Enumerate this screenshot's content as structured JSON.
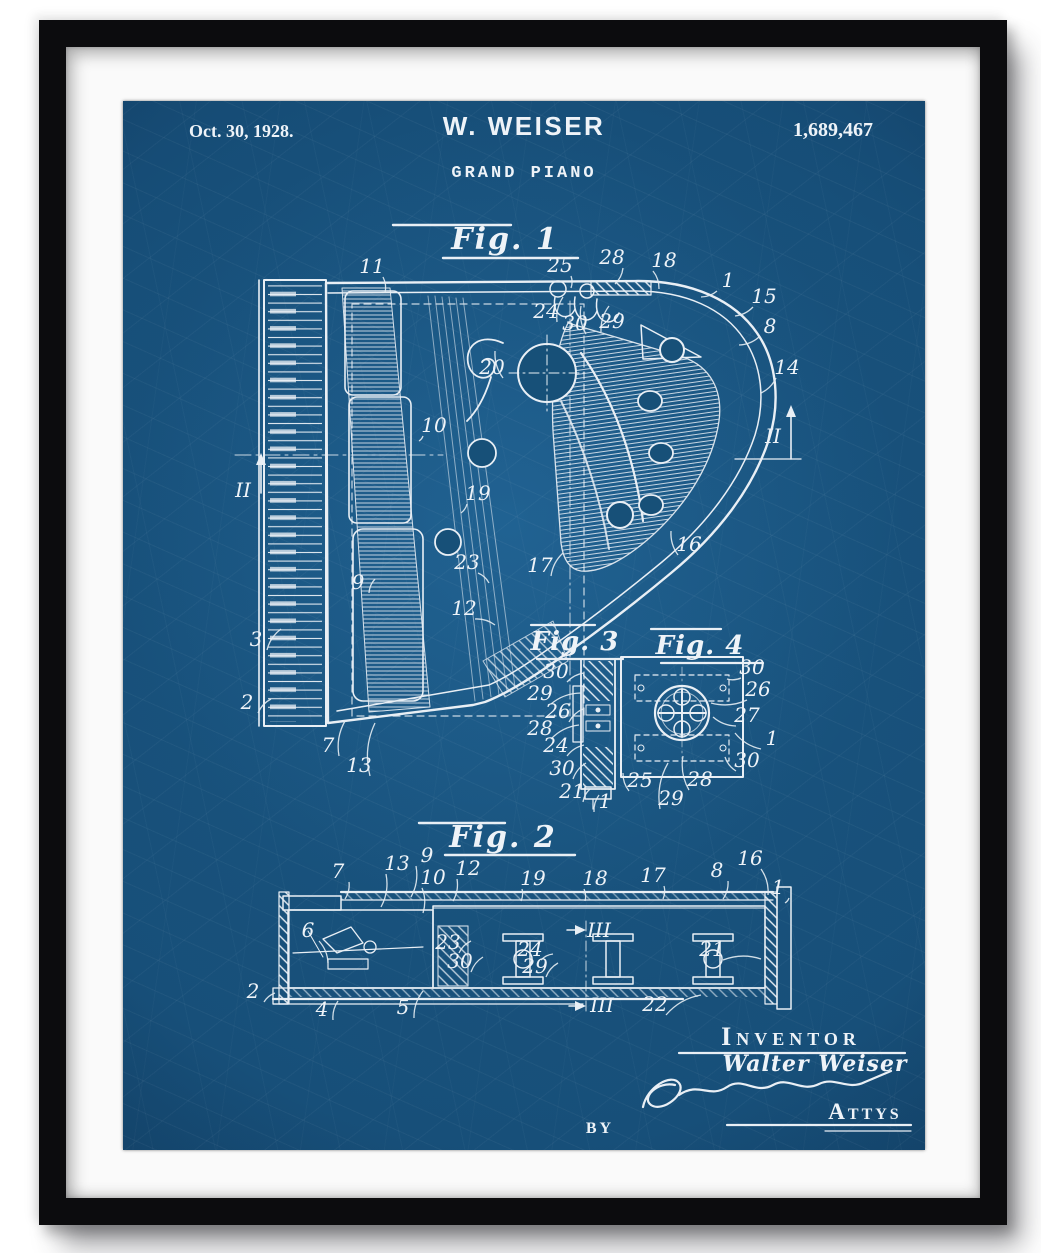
{
  "artwork": {
    "header": {
      "date": "Oct. 30, 1928.",
      "inventor_name": "W. WEISER",
      "patent_number": "1,689,467",
      "patent_title": "GRAND PIANO"
    },
    "figures": {
      "fig1": {
        "label": "Fig. 1",
        "ref_labels": [
          {
            "t": "11",
            "x": 249,
            "y": 172,
            "lx": 262,
            "ly": 192
          },
          {
            "t": "25",
            "x": 437,
            "y": 171,
            "lx": 448,
            "ly": 187
          },
          {
            "t": "28",
            "x": 489,
            "y": 163,
            "lx": 492,
            "ly": 183
          },
          {
            "t": "18",
            "x": 541,
            "y": 166,
            "lx": 536,
            "ly": 188
          },
          {
            "t": "24",
            "x": 423,
            "y": 217,
            "lx": 440,
            "ly": 196
          },
          {
            "t": "30",
            "x": 452,
            "y": 229,
            "lx": 458,
            "ly": 205
          },
          {
            "t": "29",
            "x": 489,
            "y": 227,
            "lx": 486,
            "ly": 205
          },
          {
            "t": "1",
            "x": 605,
            "y": 186,
            "lx": 578,
            "ly": 196
          },
          {
            "t": "15",
            "x": 641,
            "y": 202,
            "lx": 612,
            "ly": 215
          },
          {
            "t": "8",
            "x": 647,
            "y": 232,
            "lx": 616,
            "ly": 244
          },
          {
            "t": "14",
            "x": 664,
            "y": 273,
            "lx": 638,
            "ly": 292
          },
          {
            "t": "II",
            "x": 650,
            "y": 342
          },
          {
            "t": "20",
            "x": 369,
            "y": 273,
            "lx": 372,
            "ly": 250
          },
          {
            "t": "10",
            "x": 311,
            "y": 331,
            "lx": 296,
            "ly": 340
          },
          {
            "t": "II",
            "x": 120,
            "y": 396
          },
          {
            "t": "19",
            "x": 355,
            "y": 399,
            "lx": 338,
            "ly": 412
          },
          {
            "t": "9",
            "x": 235,
            "y": 488,
            "lx": 252,
            "ly": 478
          },
          {
            "t": "23",
            "x": 344,
            "y": 468,
            "lx": 366,
            "ly": 482
          },
          {
            "t": "12",
            "x": 341,
            "y": 514,
            "lx": 372,
            "ly": 524
          },
          {
            "t": "3",
            "x": 133,
            "y": 545,
            "lx": 158,
            "ly": 528
          },
          {
            "t": "2",
            "x": 124,
            "y": 608,
            "lx": 148,
            "ly": 598
          },
          {
            "t": "7",
            "x": 205,
            "y": 651,
            "lx": 222,
            "ly": 620
          },
          {
            "t": "13",
            "x": 236,
            "y": 671,
            "lx": 252,
            "ly": 622
          },
          {
            "t": "17",
            "x": 417,
            "y": 471,
            "lx": 440,
            "ly": 452
          },
          {
            "t": "16",
            "x": 566,
            "y": 450,
            "lx": 548,
            "ly": 430
          }
        ]
      },
      "fig2": {
        "label": "Fig. 2",
        "ref_labels": [
          {
            "t": "7",
            "x": 215,
            "y": 777,
            "lx": 222,
            "ly": 798
          },
          {
            "t": "13",
            "x": 274,
            "y": 769,
            "lx": 258,
            "ly": 806
          },
          {
            "t": "9",
            "x": 304,
            "y": 761,
            "lx": 288,
            "ly": 796
          },
          {
            "t": "10",
            "x": 310,
            "y": 783,
            "lx": 300,
            "ly": 812
          },
          {
            "t": "12",
            "x": 345,
            "y": 774,
            "lx": 330,
            "ly": 800
          },
          {
            "t": "19",
            "x": 410,
            "y": 784,
            "lx": 398,
            "ly": 800
          },
          {
            "t": "18",
            "x": 472,
            "y": 784,
            "lx": 462,
            "ly": 800
          },
          {
            "t": "17",
            "x": 530,
            "y": 781,
            "lx": 540,
            "ly": 798
          },
          {
            "t": "8",
            "x": 594,
            "y": 776,
            "lx": 600,
            "ly": 798
          },
          {
            "t": "16",
            "x": 627,
            "y": 764,
            "lx": 645,
            "ly": 794
          },
          {
            "t": "1",
            "x": 655,
            "y": 793,
            "lx": 662,
            "ly": 802
          },
          {
            "t": "6",
            "x": 185,
            "y": 836,
            "lx": 205,
            "ly": 862
          },
          {
            "t": "23",
            "x": 325,
            "y": 848,
            "lx": 348,
            "ly": 840
          },
          {
            "t": "30",
            "x": 337,
            "y": 867,
            "lx": 360,
            "ly": 856
          },
          {
            "t": "24",
            "x": 407,
            "y": 855,
            "lx": 430,
            "ly": 853
          },
          {
            "t": "29",
            "x": 412,
            "y": 872,
            "lx": 435,
            "ly": 862
          },
          {
            "t": "III",
            "x": 476,
            "y": 836
          },
          {
            "t": "III",
            "x": 479,
            "y": 911
          },
          {
            "t": "21",
            "x": 589,
            "y": 855,
            "lx": 638,
            "ly": 858
          },
          {
            "t": "22",
            "x": 532,
            "y": 910,
            "lx": 578,
            "ly": 894
          },
          {
            "t": "2",
            "x": 130,
            "y": 897,
            "lx": 152,
            "ly": 892
          },
          {
            "t": "4",
            "x": 199,
            "y": 915,
            "lx": 215,
            "ly": 900
          },
          {
            "t": "5",
            "x": 280,
            "y": 913,
            "lx": 300,
            "ly": 890
          }
        ]
      },
      "fig3": {
        "label": "Fig. 3",
        "ref_labels": [
          {
            "t": "30",
            "x": 433,
            "y": 577,
            "lx": 461,
            "ly": 572
          },
          {
            "t": "29",
            "x": 417,
            "y": 599,
            "lx": 458,
            "ly": 592
          },
          {
            "t": "26",
            "x": 435,
            "y": 617,
            "lx": 460,
            "ly": 608
          },
          {
            "t": "28",
            "x": 417,
            "y": 634,
            "lx": 456,
            "ly": 624
          },
          {
            "t": "24",
            "x": 433,
            "y": 651,
            "lx": 461,
            "ly": 644
          },
          {
            "t": "30",
            "x": 439,
            "y": 674,
            "lx": 463,
            "ly": 662
          },
          {
            "t": "21",
            "x": 449,
            "y": 697,
            "lx": 467,
            "ly": 688
          },
          {
            "t": "25",
            "x": 517,
            "y": 686,
            "lx": 500,
            "ly": 672
          },
          {
            "t": "1",
            "x": 482,
            "y": 707,
            "lx": 476,
            "ly": 694
          },
          {
            "t": "29",
            "x": 548,
            "y": 704,
            "lx": 545,
            "ly": 662
          },
          {
            "t": "28",
            "x": 577,
            "y": 685,
            "lx": 560,
            "ly": 655
          }
        ]
      },
      "fig4": {
        "label": "Fig. 4",
        "ref_labels": [
          {
            "t": "30",
            "x": 629,
            "y": 573,
            "lx": 604,
            "ly": 578
          },
          {
            "t": "26",
            "x": 635,
            "y": 595,
            "lx": 588,
            "ly": 602
          },
          {
            "t": "27",
            "x": 624,
            "y": 621,
            "lx": 590,
            "ly": 616
          },
          {
            "t": "1",
            "x": 649,
            "y": 644,
            "lx": 612,
            "ly": 632
          },
          {
            "t": "30",
            "x": 624,
            "y": 666,
            "lx": 602,
            "ly": 656
          }
        ]
      }
    },
    "signature_block": {
      "inventor_caption": "Inventor",
      "inventor_signature": "Walter Weiser",
      "by_label": "by",
      "attorneys_label": "Attys"
    }
  },
  "colors": {
    "page_background": "#ffffff",
    "frame": "#0c0c0e",
    "mat": "#fafafa",
    "blueprint_blue": "#174f79",
    "ink_white": "#e9eff5"
  }
}
